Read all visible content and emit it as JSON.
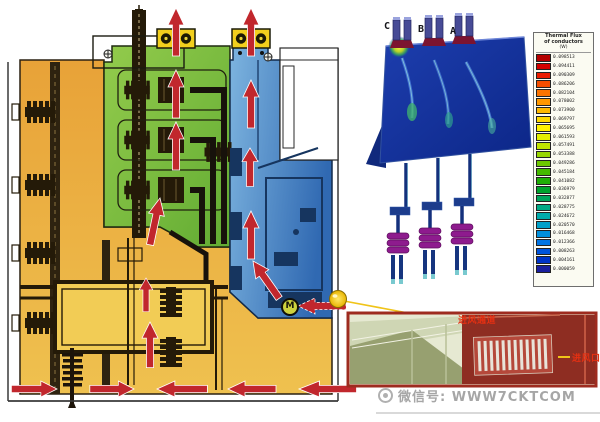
{
  "diagram": {
    "fan_label": "M",
    "colors": {
      "cable_compartment": "#ECA83D",
      "busbar_compartment": "#76BC3F",
      "riser_compartment": "#4D95D0",
      "exhaust_box": "#F2CF1D",
      "airflow_arrow": "#C1272D",
      "inset_border": "#9E2B1F",
      "label_red": "#E53012",
      "leader_yellow": "#F0C419"
    }
  },
  "cfd": {
    "phase_labels": [
      "C",
      "B",
      "A"
    ],
    "legend": {
      "title_line1": "Thermal Flux",
      "title_line2": "of conductors",
      "title_line3": "(W)",
      "entries": [
        {
          "color": "#b40000",
          "value": "0.098513"
        },
        {
          "color": "#d40000",
          "value": "0.094411"
        },
        {
          "color": "#ec1c00",
          "value": "0.090309"
        },
        {
          "color": "#f44d00",
          "value": "0.086206"
        },
        {
          "color": "#fb7300",
          "value": "0.082104"
        },
        {
          "color": "#ff9700",
          "value": "0.078002"
        },
        {
          "color": "#ffb800",
          "value": "0.073900"
        },
        {
          "color": "#ffd800",
          "value": "0.069797"
        },
        {
          "color": "#fff200",
          "value": "0.065695"
        },
        {
          "color": "#e4ef00",
          "value": "0.061593"
        },
        {
          "color": "#c0e400",
          "value": "0.057491"
        },
        {
          "color": "#97d600",
          "value": "0.053388"
        },
        {
          "color": "#6cc700",
          "value": "0.049286"
        },
        {
          "color": "#44ba00",
          "value": "0.045184"
        },
        {
          "color": "#1fae06",
          "value": "0.041082"
        },
        {
          "color": "#00a32d",
          "value": "0.036979"
        },
        {
          "color": "#00a65c",
          "value": "0.032877"
        },
        {
          "color": "#00aa85",
          "value": "0.028775"
        },
        {
          "color": "#00abab",
          "value": "0.024672"
        },
        {
          "color": "#00a0c8",
          "value": "0.020570"
        },
        {
          "color": "#008fdc",
          "value": "0.016468"
        },
        {
          "color": "#0074e4",
          "value": "0.012366"
        },
        {
          "color": "#0054dc",
          "value": "0.008263"
        },
        {
          "color": "#0034c8",
          "value": "0.004161"
        },
        {
          "color": "#1a1f9e",
          "value": "0.000059"
        }
      ]
    }
  },
  "inset": {
    "duct_label": "进风通道",
    "inlet_label": "进风口"
  },
  "watermark": {
    "text": "微信号: WWW7CKTCOM"
  }
}
